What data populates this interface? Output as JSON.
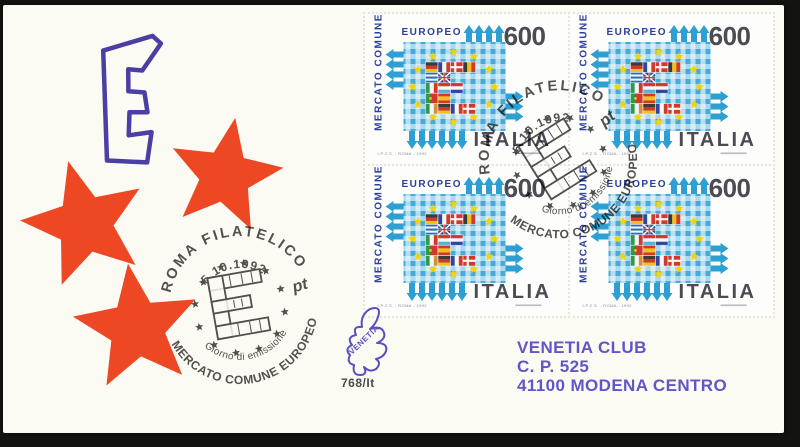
{
  "cover": {
    "cachet_letter": "E"
  },
  "stamp": {
    "series_vertical": "MERCATO COMUNE",
    "series_top": "EUROPEO",
    "denomination": "600",
    "country": "ITALIA",
    "imprint": "I.P.Z.S. - ROMA - 1992",
    "flags": {
      "members": [
        {
          "name": "germany-flag",
          "layout": "h",
          "colors": [
            "#3a3a3a",
            "#cf3a2c",
            "#f0c020"
          ]
        },
        {
          "name": "france-flag",
          "layout": "v",
          "colors": [
            "#32459e",
            "#f6f6f4",
            "#cf3a2c"
          ]
        },
        {
          "name": "denmark-flag",
          "layout": "cross",
          "colors": [
            "#cf3a2c",
            "#f6f6f4"
          ]
        },
        {
          "name": "belgium-flag",
          "layout": "v",
          "colors": [
            "#3a3a3a",
            "#f0c020",
            "#cf3a2c"
          ]
        },
        {
          "name": "greece-flag",
          "layout": "gr",
          "colors": [
            "#2f6cb4",
            "#f6f6f4"
          ]
        },
        {
          "name": "uk-flag",
          "layout": "union",
          "colors": [
            "#32459e",
            "#f6f6f4",
            "#cf3a2c"
          ]
        },
        {
          "name": "italy-flag",
          "layout": "v",
          "colors": [
            "#2f9a4c",
            "#f6f6f4",
            "#cf3a2c"
          ]
        },
        {
          "name": "luxembourg-flag",
          "layout": "h",
          "colors": [
            "#cf3a2c",
            "#f6f6f4",
            "#5aaede"
          ]
        },
        {
          "name": "netherlands-flag",
          "layout": "h",
          "colors": [
            "#cf3a2c",
            "#f6f6f4",
            "#32459e"
          ]
        },
        {
          "name": "portugal-flag",
          "layout": "pt",
          "colors": [
            "#2f9a4c",
            "#cf3a2c",
            "#f0c020"
          ]
        },
        {
          "name": "spain-flag",
          "layout": "es",
          "colors": [
            "#cf3a2c",
            "#f0c020"
          ]
        },
        {
          "name": "ireland-flag",
          "layout": "v",
          "colors": [
            "#2f9a4c",
            "#f6f6f4",
            "#e08a3c"
          ]
        }
      ]
    }
  },
  "postmark": {
    "city": "ROMA FILATELICO",
    "date": "5.10.1992",
    "issue_line": "Giorno di emissione",
    "series_line": "MERCATO COMUNE EUROPEO",
    "pt": "pt"
  },
  "address": {
    "line1": "VENETIA CLUB",
    "line2": "C. P. 525",
    "line3": "41100 MODENA CENTRO"
  },
  "publisher": {
    "logo": "VENETIA",
    "code": "768/It"
  },
  "colors": {
    "cachet_star": "#ee4723",
    "cachet_letter": "#4b3fa3",
    "address_purple": "#6156c7",
    "stamp_text_blue": "#2b3f9e",
    "stamp_gray": "#4b4b54",
    "stamp_blue": "#2d9fd3",
    "star_yellow": "#f2d404",
    "cancel_ink": "#3e3e3e"
  }
}
